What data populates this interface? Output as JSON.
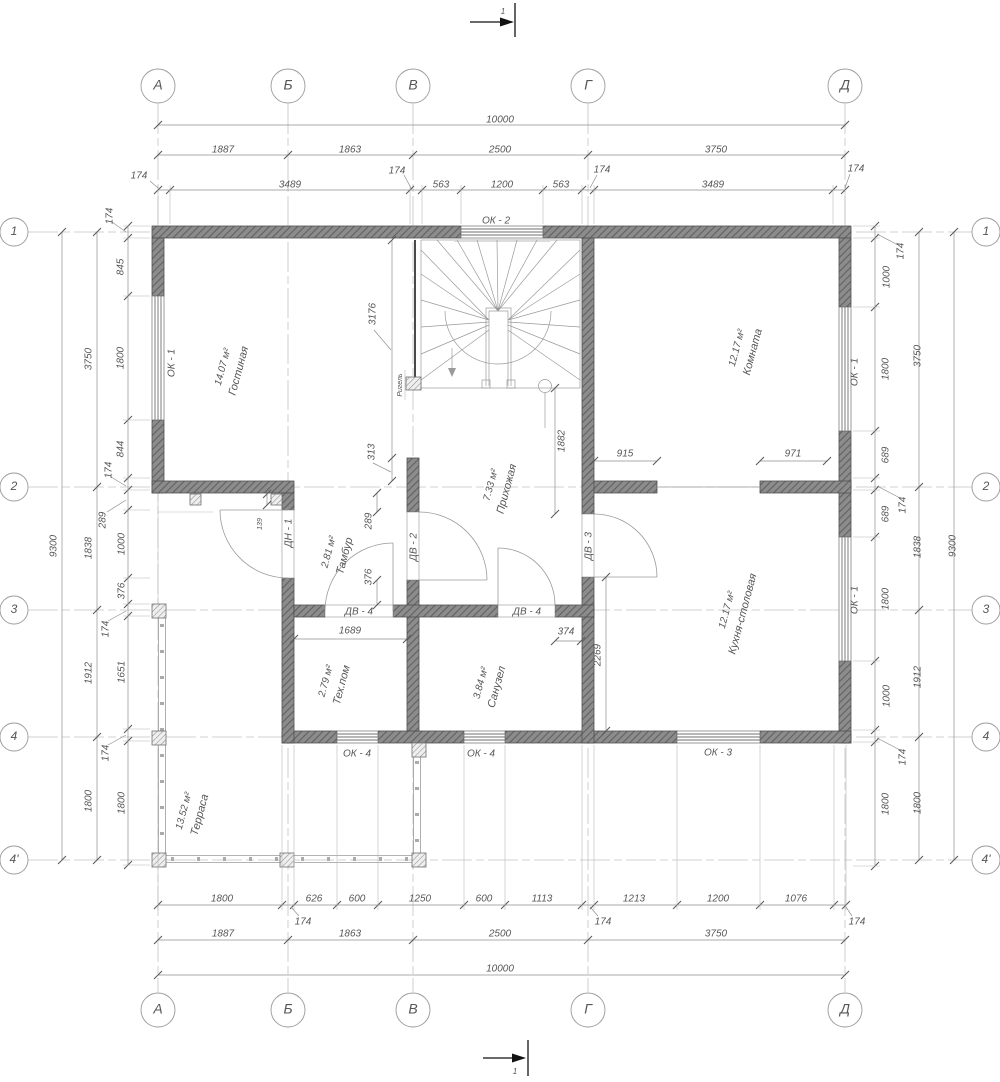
{
  "drawing_type": "floor-plan",
  "colors": {
    "wall": "#6f6f6f",
    "line": "#9a9a9a",
    "text": "#565656",
    "accent": "#121212"
  },
  "axes": {
    "h": [
      "А",
      "Б",
      "В",
      "Г",
      "Д"
    ],
    "v": [
      "1",
      "2",
      "3",
      "4",
      "4'"
    ]
  },
  "section": {
    "label": "1"
  },
  "beam": {
    "label": "Ригель"
  },
  "rooms": [
    {
      "name": "Гостиная",
      "area": "14.07 м²"
    },
    {
      "name": "Комната",
      "area": "12.17 м²"
    },
    {
      "name": "Прихожая",
      "area": "7.33 м²"
    },
    {
      "name": "Тамбур",
      "area": "2.81 м²"
    },
    {
      "name": "Тех.пом",
      "area": "2.79 м²"
    },
    {
      "name": "Санузел",
      "area": "3.84 м²"
    },
    {
      "name": "Кухня-столовая",
      "area": "12.17 м²"
    },
    {
      "name": "Терраса",
      "area": "13.52 м²"
    }
  ],
  "openings": {
    "ok1": "ОК - 1",
    "ok2": "ОК - 2",
    "ok3": "ОК - 3",
    "ok4": "ОК - 4",
    "dv2": "ДВ - 2",
    "dv3": "ДВ - 3",
    "dv4": "ДВ - 4",
    "dn1": "ДН - 1"
  },
  "dims": {
    "top": {
      "total": "10000",
      "axes": [
        "1887",
        "1863",
        "2500",
        "3750"
      ],
      "detail": [
        "174",
        "3489",
        "174",
        "563",
        "1200",
        "563",
        "174",
        "3489",
        "174"
      ]
    },
    "bottom": {
      "total": "10000",
      "axes": [
        "1887",
        "1863",
        "2500",
        "3750"
      ],
      "detail": [
        "1800",
        "174",
        "626",
        "600",
        "1250",
        "600",
        "1113",
        "174",
        "1213",
        "1200",
        "1076",
        "174"
      ]
    },
    "left": {
      "total": "9300",
      "axes": [
        "3750",
        "1838",
        "1912",
        "1800"
      ],
      "detail": [
        "174",
        "845",
        "1800",
        "844",
        "174",
        "289",
        "1000",
        "376",
        "174",
        "1651",
        "174",
        "1800"
      ]
    },
    "right": {
      "total": "9300",
      "axes": [
        "3750",
        "1838",
        "1912",
        "1800"
      ],
      "detail": [
        "174",
        "1000",
        "1800",
        "689",
        "174",
        "689",
        "1800",
        "1000",
        "174",
        "1800"
      ]
    },
    "interior": {
      "stair": "3176",
      "beam_offset": "313",
      "hall": "1882",
      "opening_l": "915",
      "opening_r": "971",
      "tambour_a": "289",
      "tambour_b": "376",
      "porch": "139",
      "tech": "1689",
      "wc": "374",
      "kitchen": "2269"
    }
  }
}
